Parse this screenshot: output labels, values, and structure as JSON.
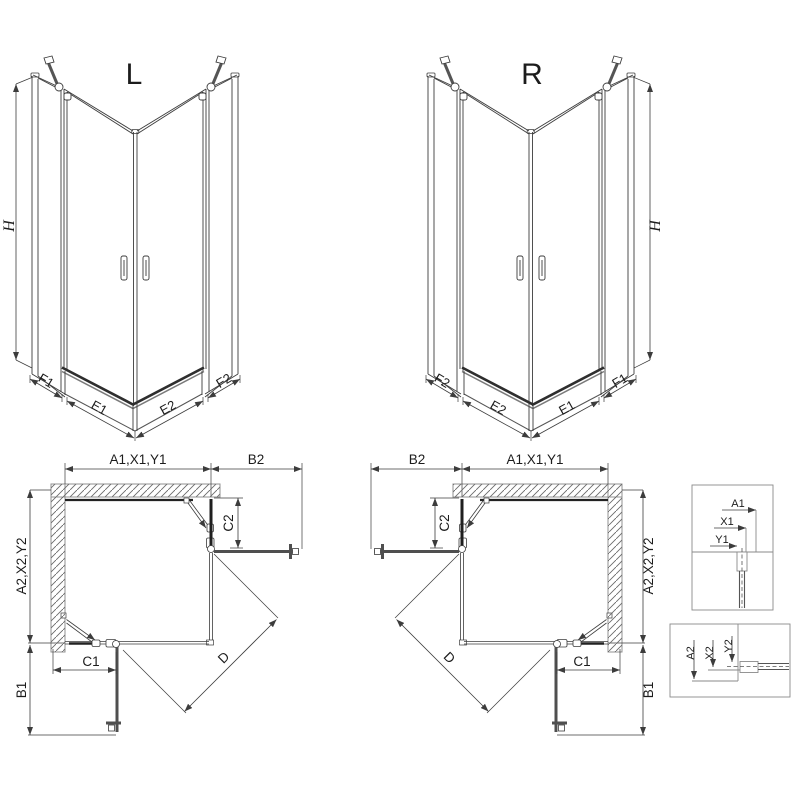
{
  "drawing": {
    "variant_left_title": "L",
    "variant_right_title": "R",
    "height_label": "H"
  },
  "segment_labels": {
    "f1": "F1",
    "e1": "E1",
    "e2": "E2",
    "f2": "F2"
  },
  "plan_labels": {
    "top_width": "A1,X1,Y1",
    "side_width": "A2,X2,Y2",
    "b1": "B1",
    "b2": "B2",
    "c1": "C1",
    "c2": "C2",
    "d": "D"
  },
  "detail_top": {
    "a1": "A1",
    "x1": "X1",
    "y1": "Y1"
  },
  "detail_bottom": {
    "a2": "A2",
    "x2": "X2",
    "y2": "Y2"
  },
  "colors": {
    "line": "#3c3c3c",
    "wall_outline": "#909090",
    "hatch": "#6a6a6a",
    "door_gray": "#4f4f4f",
    "rim_dark": "#2e2e2e"
  }
}
